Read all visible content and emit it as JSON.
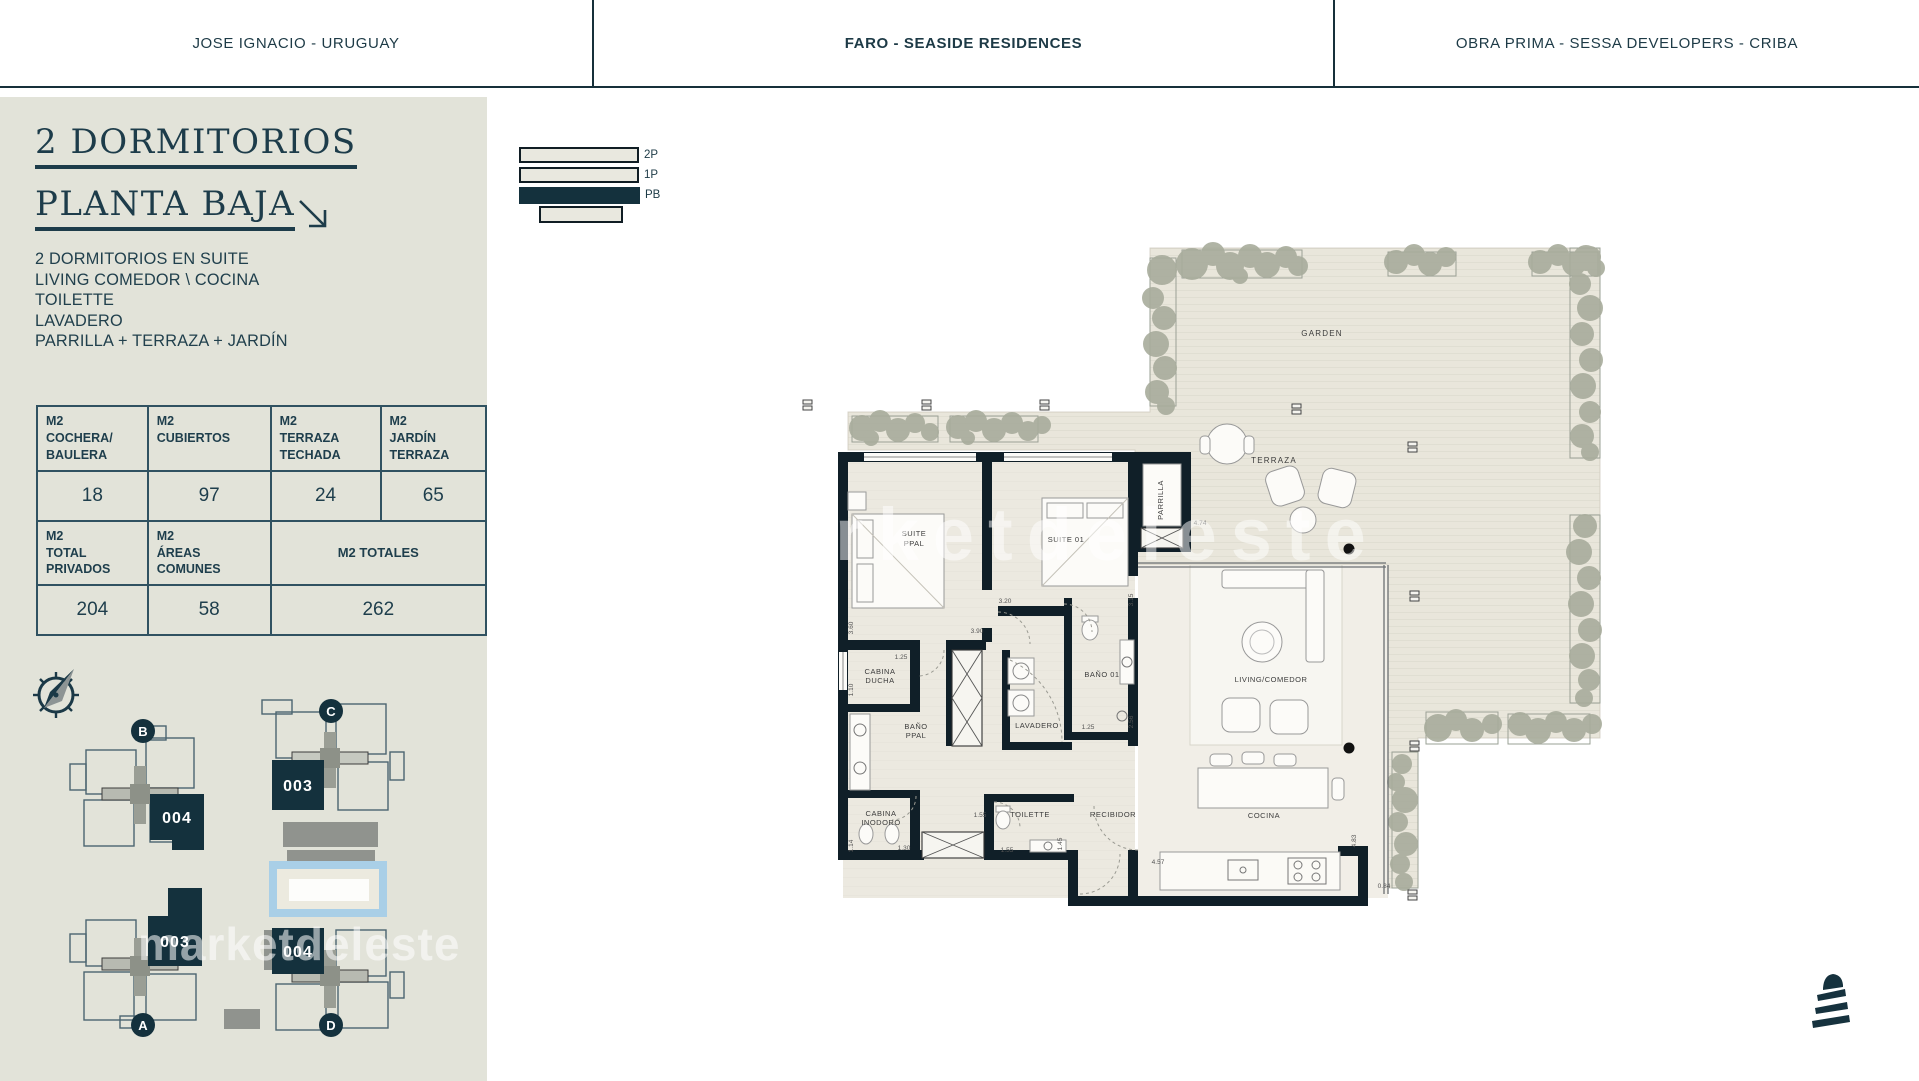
{
  "header": {
    "left": "JOSE IGNACIO - URUGUAY",
    "center": "FARO - SEASIDE RESIDENCES",
    "right": "OBRA PRIMA - SESSA DEVELOPERS - CRIBA"
  },
  "unit": {
    "title_line1": "2 DORMITORIOS",
    "title_line2": "PLANTA BAJA",
    "features": [
      "2 DORMITORIOS EN SUITE",
      "LIVING COMEDOR \\ COCINA",
      "TOILETTE",
      "LAVADERO",
      "PARRILLA + TERRAZA + JARDÍN"
    ]
  },
  "area_table": {
    "h_cochera": "M2\nCOCHERA/\nBAULERA",
    "h_cubiertos": "M2\nCUBIERTOS",
    "h_terraza": "M2\nTERRAZA\nTECHADA",
    "h_jardin": "M2\nJARDÍN\nTERRAZA",
    "v_cochera": "18",
    "v_cubiertos": "97",
    "v_terraza": "24",
    "v_jardin": "65",
    "h_privados": "M2\nTOTAL\nPRIVADOS",
    "h_comunes": "M2\nÁREAS\nCOMUNES",
    "h_totales": "M2 TOTALES",
    "v_privados": "204",
    "v_comunes": "58",
    "v_totales": "262"
  },
  "legend": {
    "floors": [
      "2P",
      "1P",
      "PB"
    ]
  },
  "site": {
    "clusters": [
      {
        "letter": "B",
        "unit": "004"
      },
      {
        "letter": "C",
        "unit": "003"
      },
      {
        "letter": "A",
        "unit": "003"
      },
      {
        "letter": "D",
        "unit": "004"
      }
    ]
  },
  "plan": {
    "garden": "GARDEN",
    "terraza": "TERRAZA",
    "parrilla": "PARRILLA",
    "suite_ppal": [
      "SUITE",
      "PPAL"
    ],
    "suite_01": "SUITE 01",
    "cabina_ducha": [
      "CABINA",
      "DUCHA"
    ],
    "bano_ppal": [
      "BAÑO",
      "PPAL"
    ],
    "cabina_inodoro": [
      "CABINA",
      "INODORO"
    ],
    "toilette": "TOILETTE",
    "lavadero": "LAVADERO",
    "bano_01": "BAÑO 01",
    "recibidor": "RECIBIDOR",
    "living": "LIVING/COMEDOR",
    "cocina": "COCINA",
    "dims": [
      "3.60",
      "3.90",
      "3.20",
      "3.15",
      "1.25",
      "1.10",
      "1.14",
      "1.30",
      "1.55",
      "1.55",
      "1.45",
      "1.25",
      "2.56",
      "4.74",
      "4.57",
      "4.83",
      "0.84"
    ]
  },
  "watermark": "marketdeleste"
}
